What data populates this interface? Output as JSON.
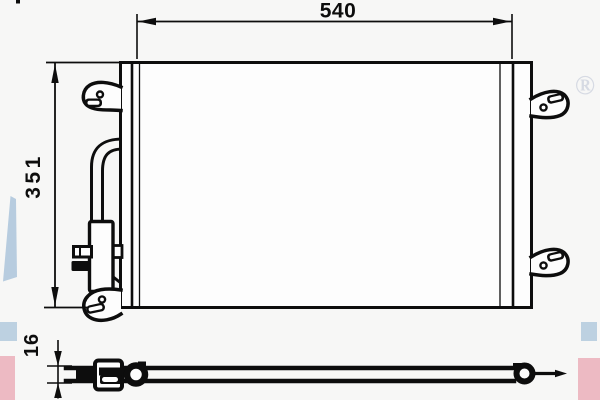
{
  "drawing": {
    "line_color": "#0d0d0d",
    "paper_color": "#f7f7f6",
    "part_fill_color": "#fdfdfd",
    "dimensions": {
      "width_mm": "540",
      "height_mm": "351",
      "depth_mm": "16"
    }
  },
  "watermarks": {
    "registered_symbol": "®",
    "symbol_color": "#d6dae3",
    "blue_color": "#bdd1e1",
    "pink_color": "#edbac3",
    "wedge_color": "#b7ccdf"
  }
}
